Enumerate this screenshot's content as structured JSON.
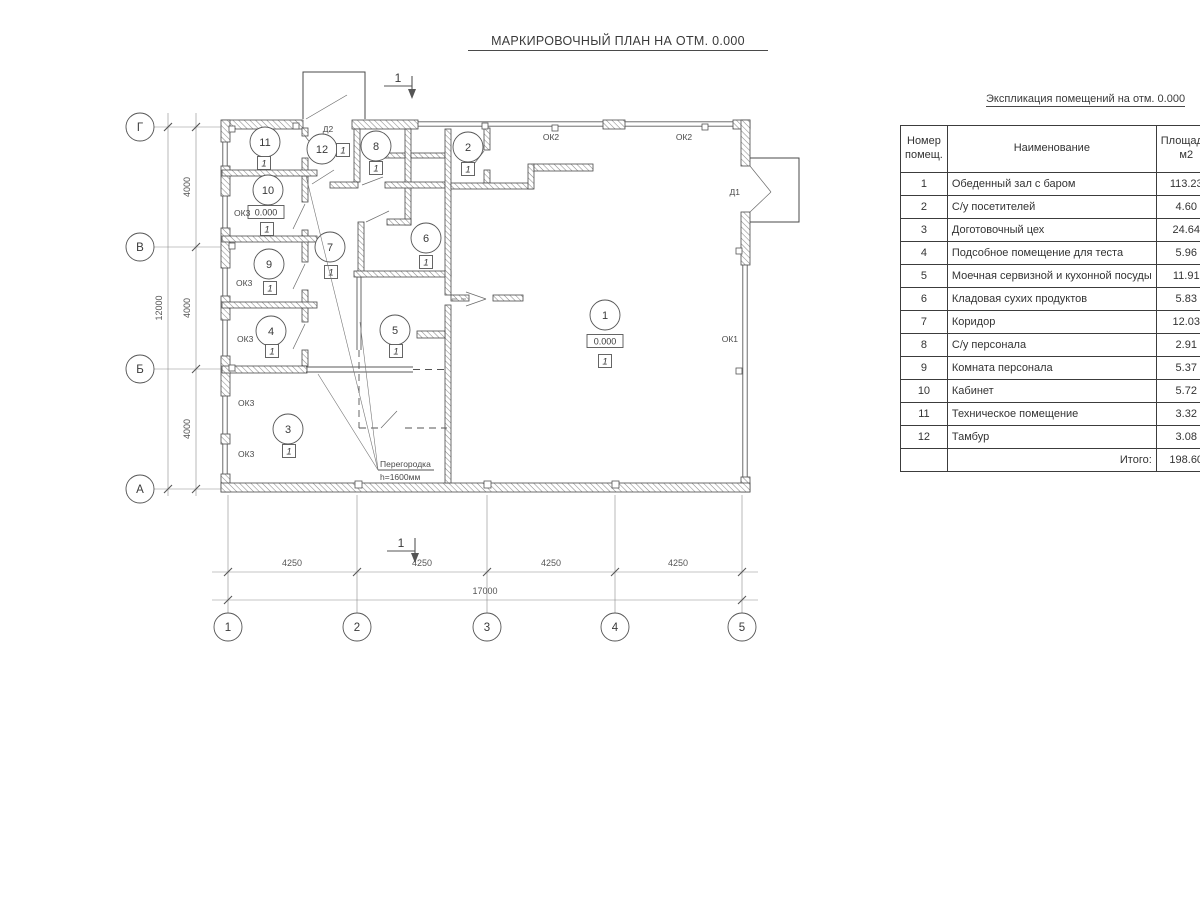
{
  "title": "МАРКИРОВОЧНЫЙ ПЛАН НА ОТМ. 0.000",
  "schedule": {
    "title": "Экспликация помещений на отм. 0.000",
    "col_number": "Номер\nпомещ.",
    "col_name": "Наименование",
    "col_area": "Площадь,\nм2",
    "col_cut": "Ка\nпо",
    "rows": [
      {
        "num": "1",
        "name": "Обеденный зал с баром",
        "area": "113.23"
      },
      {
        "num": "2",
        "name": "С/у посетителей",
        "area": "4.60"
      },
      {
        "num": "3",
        "name": "Доготовочный цех",
        "area": "24.64"
      },
      {
        "num": "4",
        "name": "Подсобное помещение для теста",
        "area": "5.96"
      },
      {
        "num": "5",
        "name": "Моечная сервизной и кухонной посуды",
        "area": "11.91"
      },
      {
        "num": "6",
        "name": "Кладовая сухих продуктов",
        "area": "5.83"
      },
      {
        "num": "7",
        "name": "Коридор",
        "area": "12.03"
      },
      {
        "num": "8",
        "name": "С/у персонала",
        "area": "2.91"
      },
      {
        "num": "9",
        "name": "Комната персонала",
        "area": "5.37"
      },
      {
        "num": "10",
        "name": "Кабинет",
        "area": "5.72"
      },
      {
        "num": "11",
        "name": "Техническое помещение",
        "area": "3.32"
      },
      {
        "num": "12",
        "name": "Тамбур",
        "area": "3.08"
      }
    ],
    "total_label": "Итого:",
    "total_value": "198.60"
  },
  "plan": {
    "rooms": [
      "1",
      "2",
      "3",
      "4",
      "5",
      "6",
      "7",
      "8",
      "9",
      "10",
      "11",
      "12"
    ],
    "floor_mark": "1",
    "elevation": "0.000",
    "section_mark": "1",
    "grid_rows": [
      "Г",
      "В",
      "Б",
      "А"
    ],
    "grid_cols": [
      "1",
      "2",
      "3",
      "4",
      "5"
    ],
    "dim_h": [
      "4250",
      "4250",
      "4250",
      "4250"
    ],
    "dim_h_total": "17000",
    "dim_v": [
      "4000",
      "4000",
      "4000"
    ],
    "dim_v_total": "12000",
    "labels": {
      "ok1": "ОК1",
      "ok2": "ОК2",
      "ok3": "ОК3",
      "d1": "Д1",
      "d2": "Д2",
      "partition_line1": "Перегородка",
      "partition_line2": "h=1600мм"
    }
  }
}
